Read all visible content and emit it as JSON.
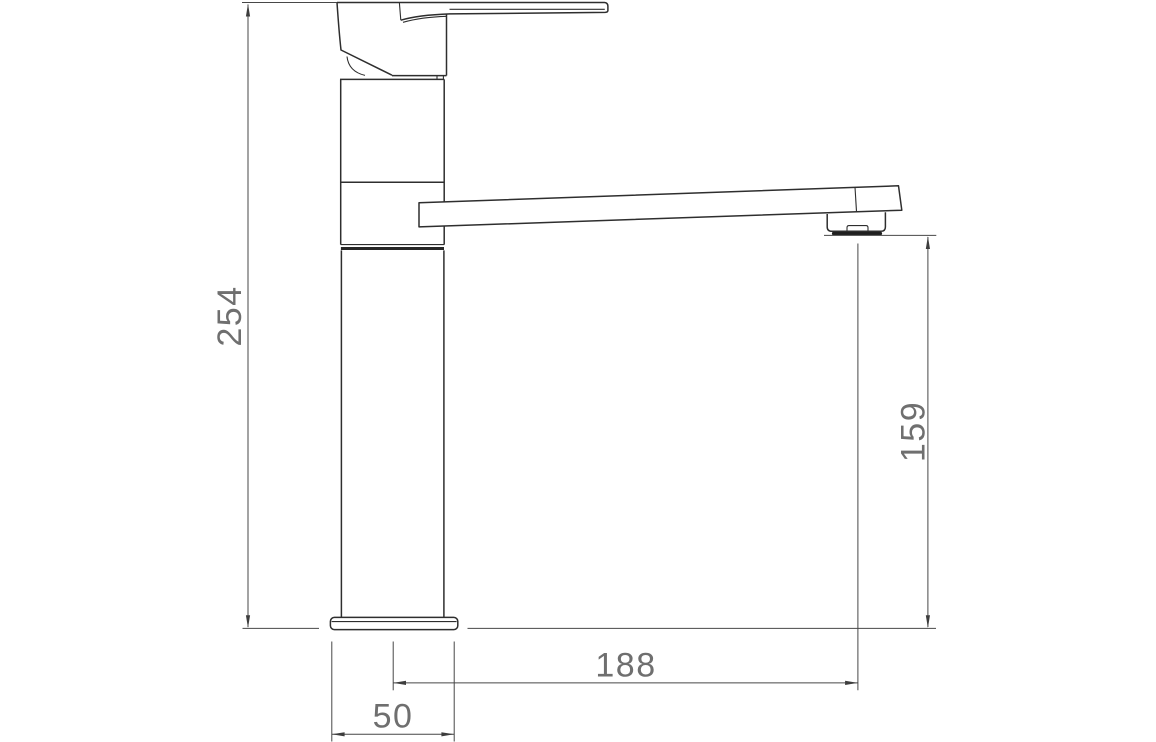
{
  "drawing": {
    "background_color": "#ffffff",
    "line_color": "#2e2e2e",
    "dimension_line_color": "#474747",
    "dimension_text_color": "#6f6f6f"
  },
  "dimensions": {
    "overall_height": "254",
    "spout_height": "159",
    "spout_reach": "188",
    "base_width": "50"
  }
}
